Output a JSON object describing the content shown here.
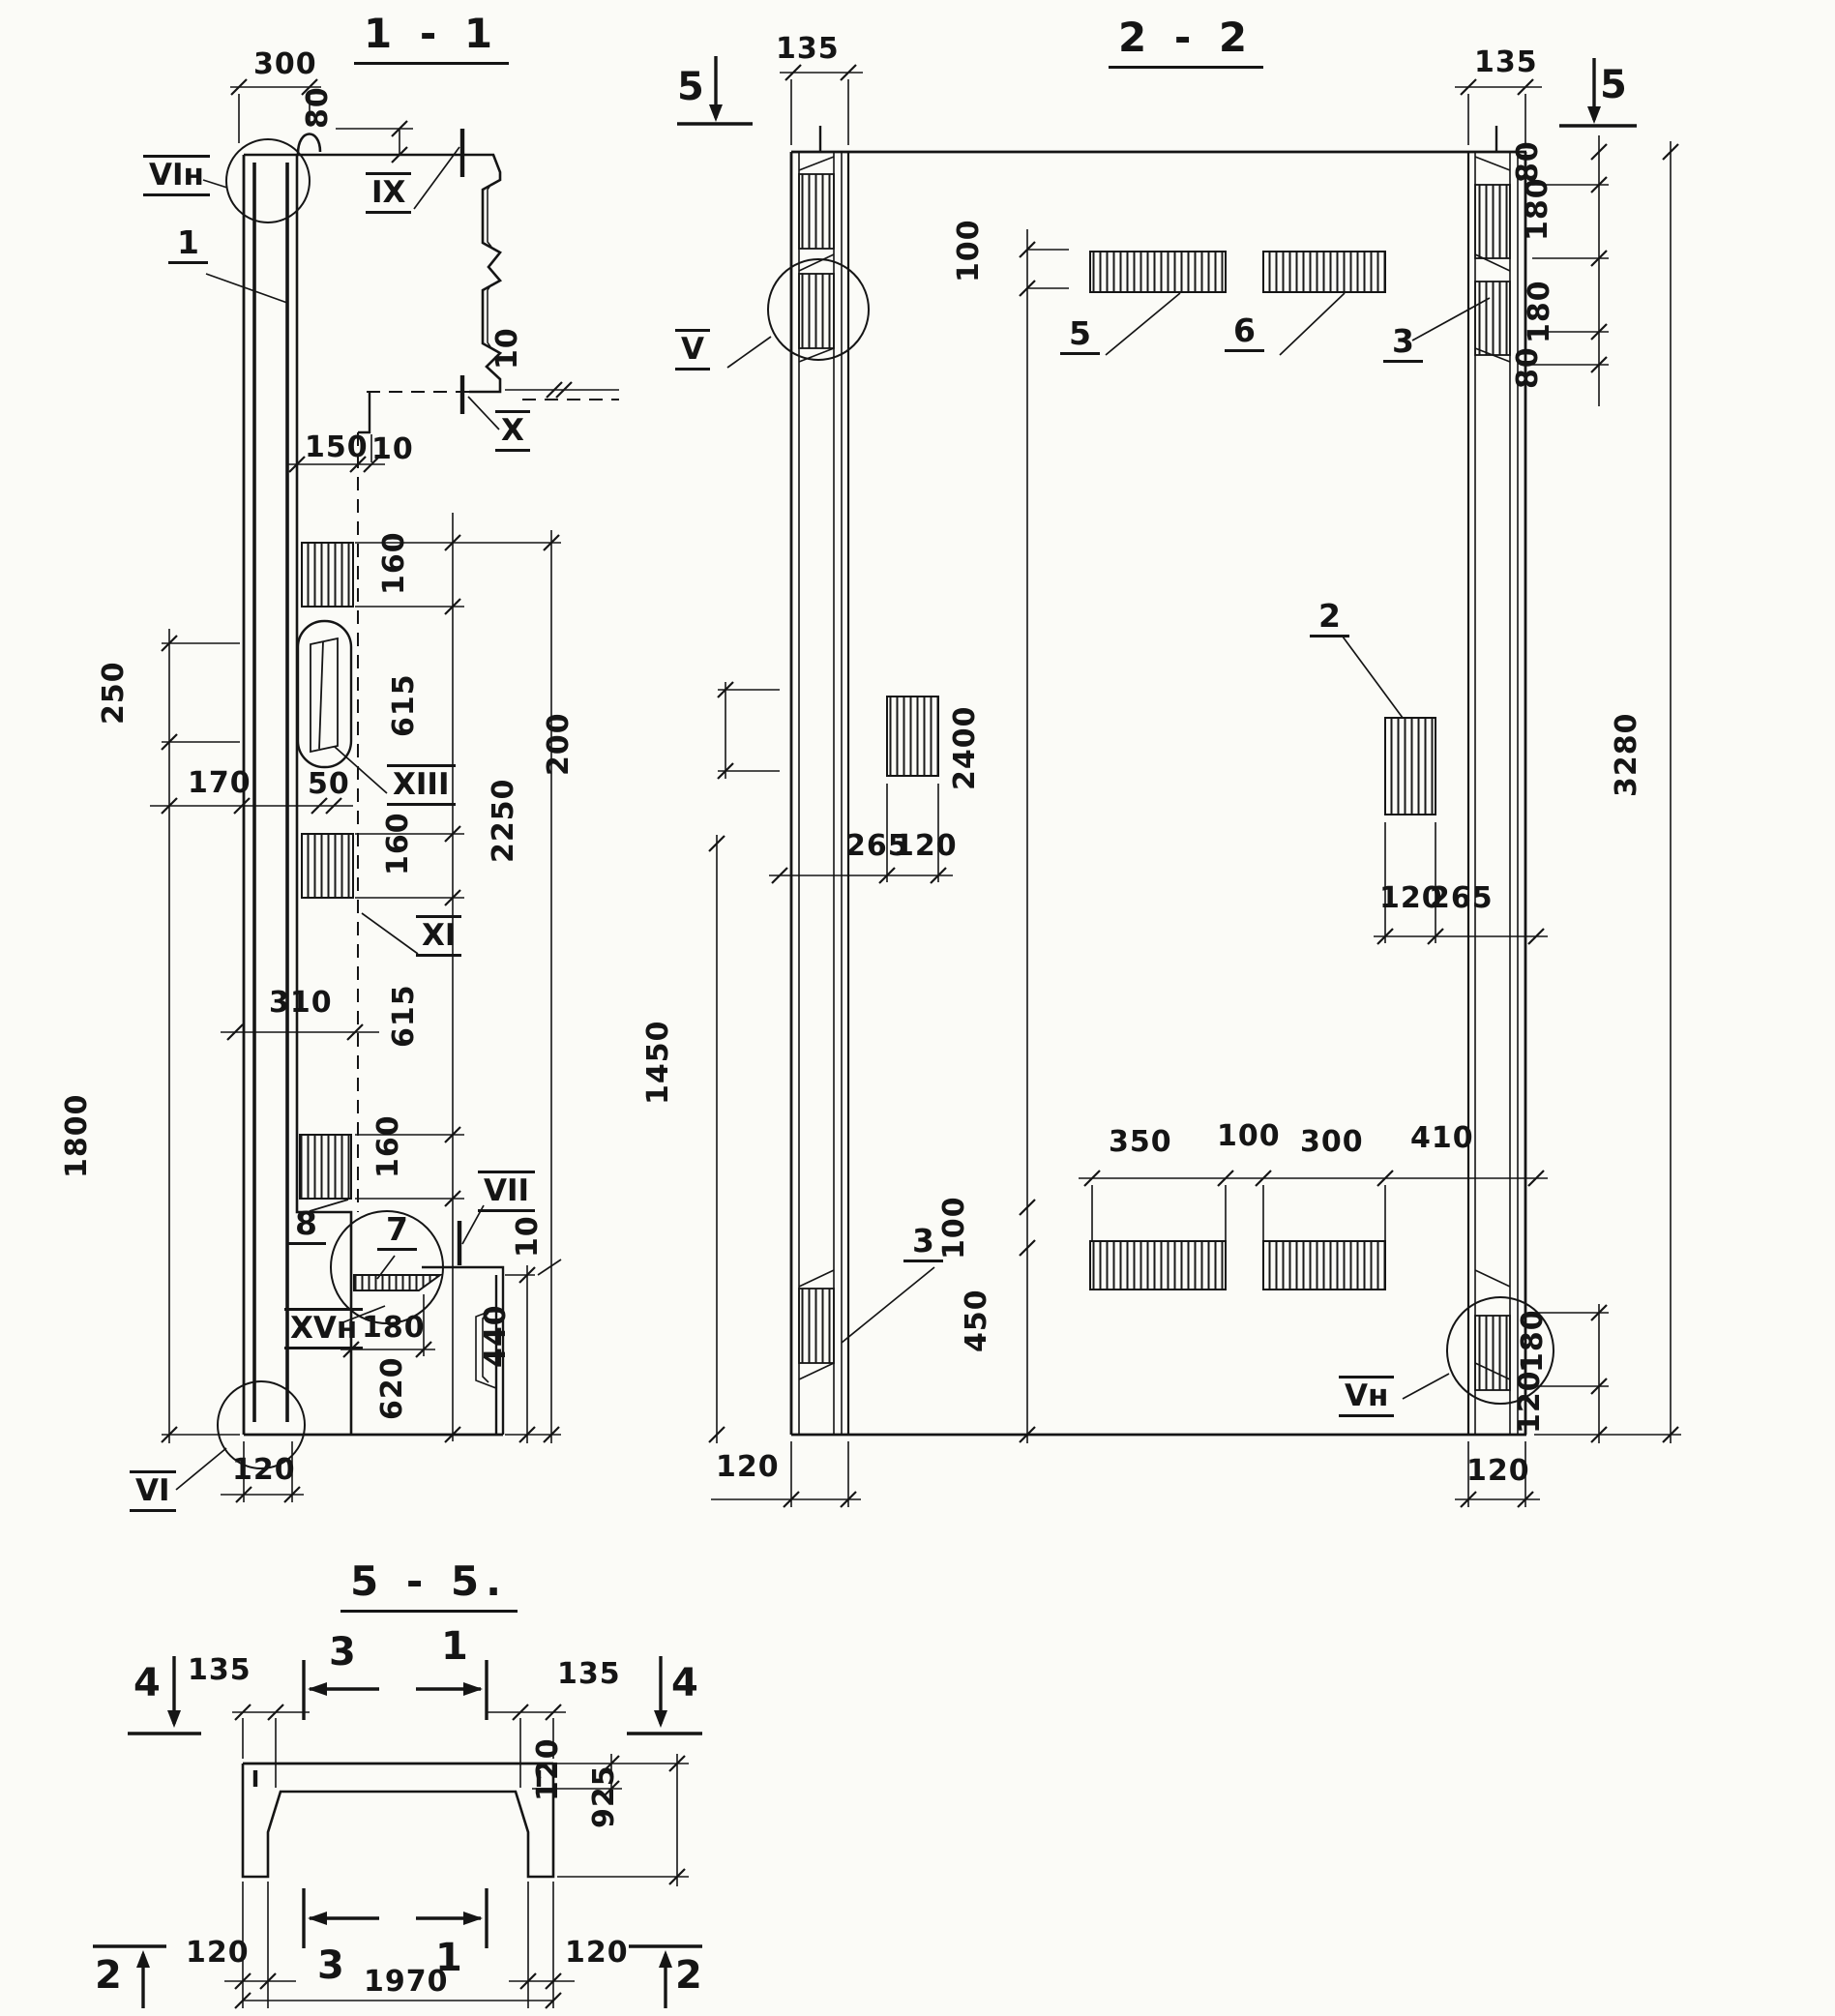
{
  "s11": {
    "title": "1 - 1",
    "callouts": {
      "vi_n": "VIн",
      "ix": "IX",
      "x": "X",
      "xiii": "XIII",
      "xi": "XI",
      "vii": "VII",
      "xv_n": "XVн",
      "vi": "VI"
    },
    "parts": {
      "p1": "1",
      "p7": "7",
      "p8": "8"
    },
    "dims": {
      "d300": "300",
      "d80": "80",
      "d150": "150",
      "d10a": "10",
      "d10c": "10",
      "d160a": "160",
      "d615a": "615",
      "d160b": "160",
      "d615b": "615",
      "d160c": "160",
      "d2250": "2250",
      "d250": "250",
      "d170": "170",
      "d50": "50",
      "d310": "310",
      "d1800": "1800",
      "d180": "180",
      "d620": "620",
      "d440": "440",
      "d10b": "10",
      "d120": "120"
    }
  },
  "s22": {
    "title": "2 - 2",
    "callouts": {
      "v": "V",
      "v_n": "Vн"
    },
    "parts": {
      "p2": "2",
      "p3a": "3",
      "p3b": "3",
      "p5": "5",
      "p6": "6"
    },
    "marks": {
      "m5l": "5",
      "m5r": "5"
    },
    "dims": {
      "d135l": "135",
      "d135r": "135",
      "d80a": "80",
      "d180a": "180",
      "d180b": "180",
      "d80b": "80",
      "d3280": "3280",
      "d100t": "100",
      "d200": "200",
      "d2400": "2400",
      "d1450": "1450",
      "d265l": "265",
      "d120l": "120",
      "d120r": "120",
      "d265r": "265",
      "d350": "350",
      "d100m": "100",
      "d300": "300",
      "d410": "410",
      "d100b": "100",
      "d450": "450",
      "d180c": "180",
      "d120rb": "120",
      "d120bl": "120",
      "d120br": "120"
    }
  },
  "s55": {
    "title": "5 - 5.",
    "marks": {
      "m4l": "4",
      "m4r": "4",
      "m3t": "3",
      "m1t": "1",
      "m3b": "3",
      "m1b": "1",
      "m2l": "2",
      "m2r": "2"
    },
    "dims": {
      "d135l": "135",
      "d135r": "135",
      "d120t": "120",
      "d925": "925",
      "d120bl": "120",
      "d120br": "120",
      "d1970": "1970"
    }
  }
}
